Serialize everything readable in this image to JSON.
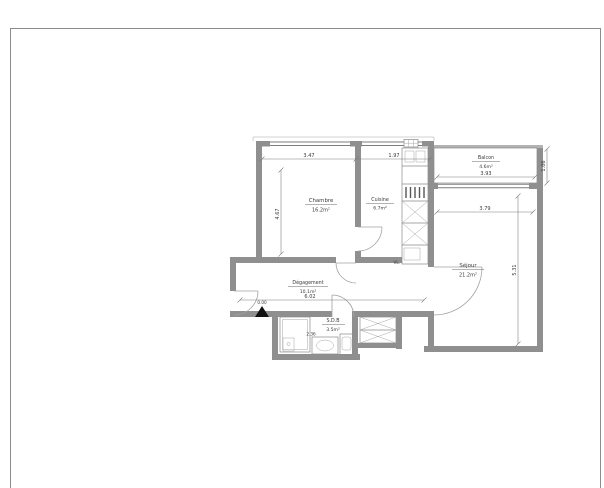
{
  "page": {
    "background": "#ffffff",
    "frame_color": "#8c8c8c"
  },
  "plan": {
    "colors": {
      "wall": "#8f8f8f",
      "line": "#7a7a7a",
      "text": "#3a3a3a",
      "marker": "#111111"
    },
    "rooms": {
      "chambre": {
        "name": "Chambre",
        "area": "16.2m²"
      },
      "cuisine": {
        "name": "Cuisine",
        "area": "6.7m²"
      },
      "sejour": {
        "name": "Séjour",
        "area": "21.2m²"
      },
      "balcon": {
        "name": "Balcon",
        "area": "4.6m²"
      },
      "degagement": {
        "name": "Dégagement",
        "area": "10.1m²"
      },
      "sdb": {
        "name": "S.D.B",
        "area": "3.5m²"
      }
    },
    "dimensions": {
      "top_chambre": "3.47",
      "top_cuisine": "1.97",
      "chambre_depth": "4.67",
      "balcon_width": "3.93",
      "balcon_depth": "1.06",
      "sejour_width": "3.79",
      "sejour_depth": "5.31",
      "hall_width": "6.02",
      "sdb_width": "2.36",
      "entry_level": "0.00",
      "duct": "VL."
    }
  }
}
